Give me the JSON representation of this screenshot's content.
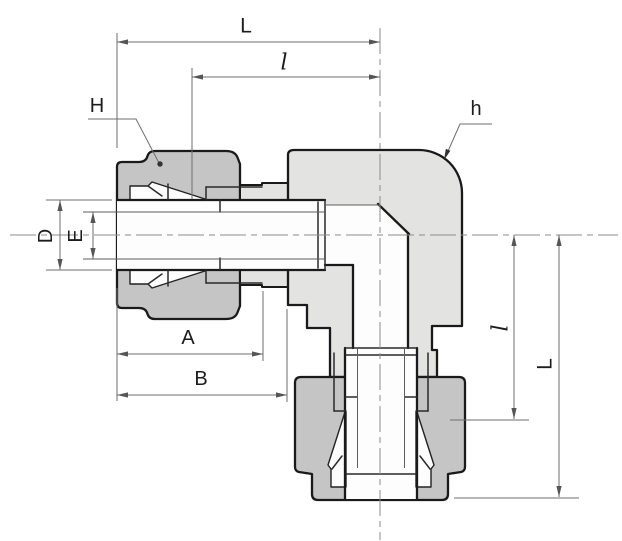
{
  "drawing": {
    "kind": "sectional technical drawing of a 90-degree elbow compression tube fitting",
    "labels": {
      "top_center_to_end": "L",
      "top_sub_length": "l",
      "nut_across_flats": "H",
      "body_across_flats": "h",
      "outer_diameter": "D",
      "inner_diameter": "E",
      "nut_length": "A",
      "body_length": "B",
      "right_sub_length": "l",
      "right_center_to_end": "L"
    },
    "colors": {
      "outline": "#1a1a1a",
      "nut_fill": "#c5c5c6",
      "body_fill": "#e3e3e2",
      "bore_fill": "#fdfdfd",
      "dimension_line": "#6e6e6e",
      "background": "#ffffff"
    }
  }
}
